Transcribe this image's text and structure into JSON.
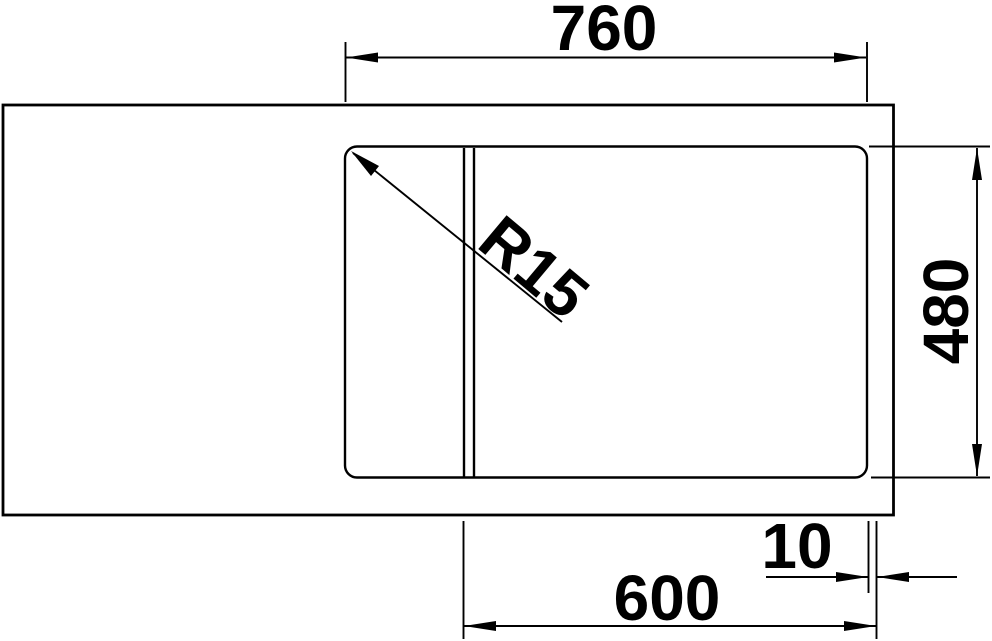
{
  "colors": {
    "line": "#000000",
    "background": "#ffffff"
  },
  "drawing": {
    "view": "sink-top-view-technical-drawing",
    "dimensions": {
      "top_width": "760",
      "right_depth": "480",
      "bottom_width": "600",
      "bottom_offset": "10",
      "corner_radius": "R15"
    }
  }
}
